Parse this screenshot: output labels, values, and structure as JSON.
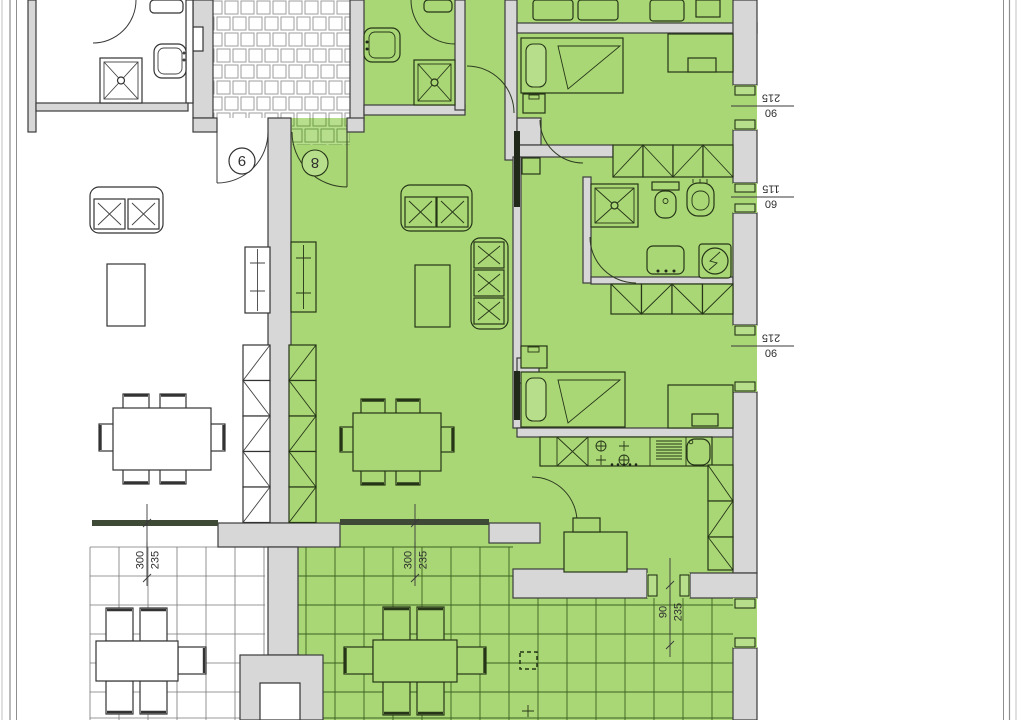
{
  "colors": {
    "highlight_green": "#a9d776",
    "highlight_green_light": "#b7de8b",
    "wall_gray": "#d7d7d7",
    "line_dark": "#333333",
    "terrace_grid_green": "#3c6120"
  },
  "doors": {
    "left_unit_number": "9",
    "right_unit_number": "8"
  },
  "dimensions": {
    "window_top_right": {
      "width": "215",
      "height": "90"
    },
    "window_small_right": {
      "width": "115",
      "height": "60"
    },
    "window_mid_right": {
      "width": "215",
      "height": "90"
    },
    "terrace_window_left": {
      "width": "300",
      "height": "235"
    },
    "terrace_window_right": {
      "width": "300",
      "height": "235"
    },
    "terrace_side_window": {
      "width": "90",
      "height": "235"
    }
  }
}
